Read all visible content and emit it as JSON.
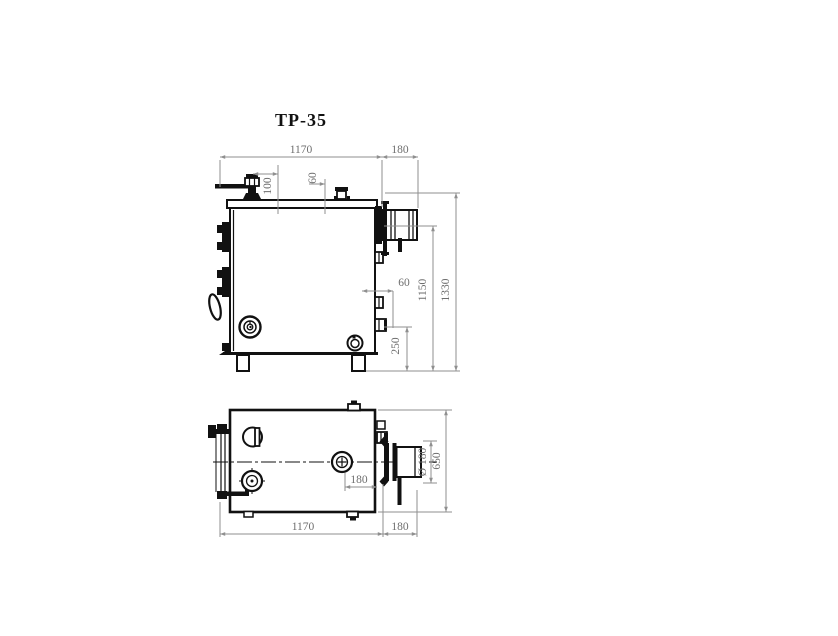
{
  "title": "ТР-35",
  "colors": {
    "outline": "#111111",
    "dim_line": "#8f8f8f",
    "dim_text": "#6e6e6e",
    "background": "#ffffff"
  },
  "side_view": {
    "name": "boiler side elevation",
    "dims": {
      "body_width": "1170",
      "flue_length": "180",
      "valve_offset": "100",
      "cap_offset": "60",
      "stub_gap": "60",
      "drain_height": "250",
      "flue_axis_height": "1150",
      "total_height": "1330"
    }
  },
  "top_view": {
    "name": "boiler plan view",
    "dims": {
      "body_width": "1170",
      "flue_length": "180",
      "fitting_offset": "180",
      "flue_diameter": "Ø 180",
      "body_depth": "650"
    }
  }
}
